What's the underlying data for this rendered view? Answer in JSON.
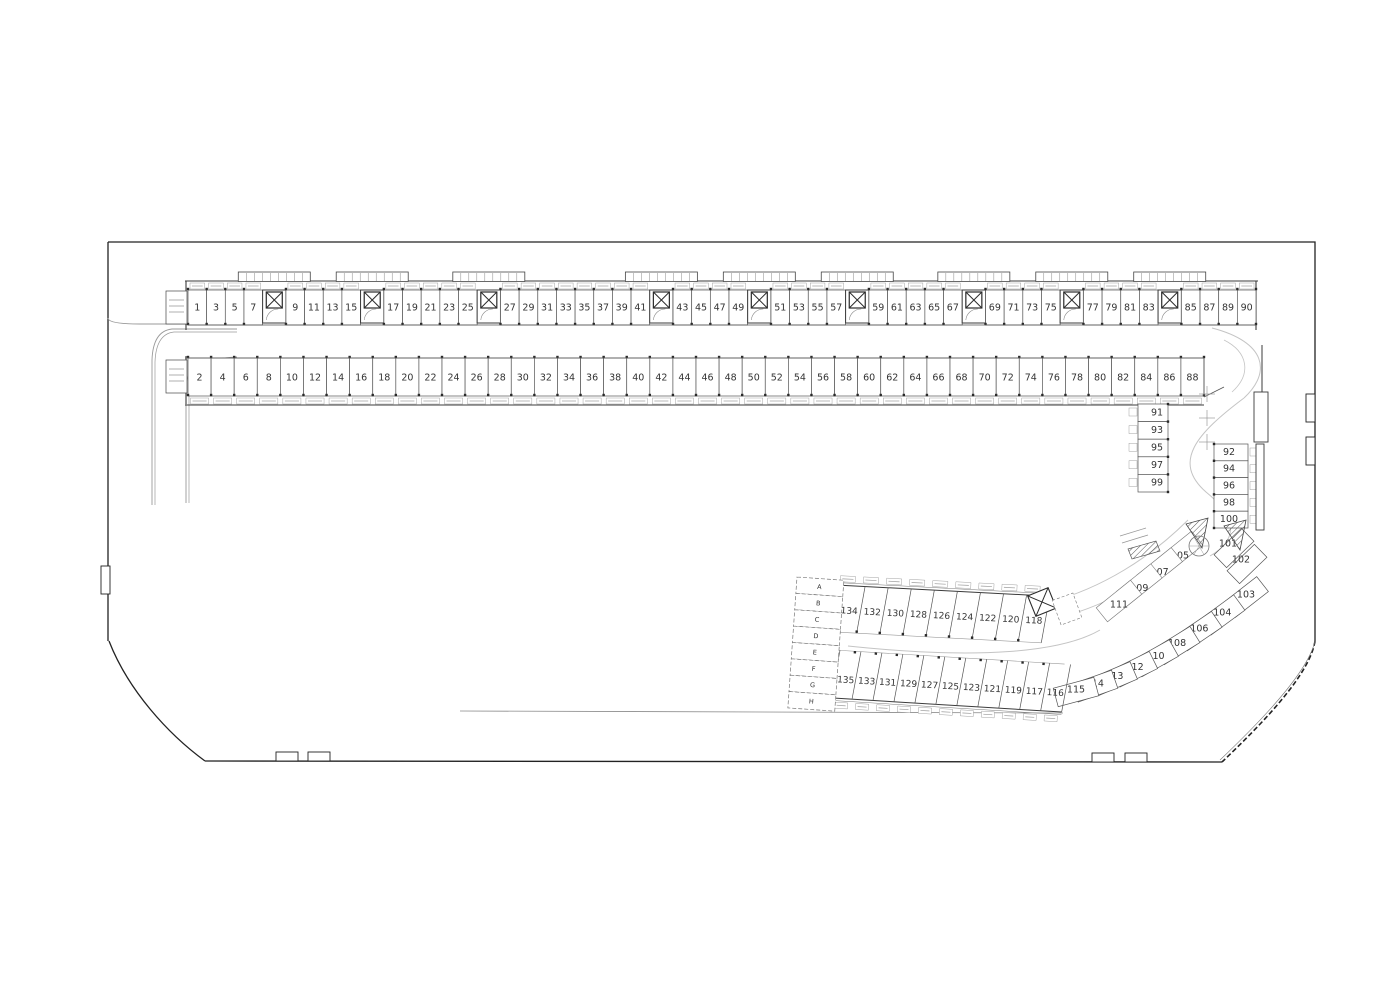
{
  "drawing": {
    "type": "parking-garage-floor-plan",
    "title": "",
    "stall_groups": {
      "top_row": {
        "sequence": [
          "1",
          "3",
          "5",
          "7",
          "CORE",
          "9",
          "11",
          "13",
          "15",
          "CORE",
          "17",
          "19",
          "21",
          "23",
          "25",
          "CORE",
          "27",
          "29",
          "31",
          "33",
          "35",
          "37",
          "39",
          "41",
          "CORE",
          "43",
          "45",
          "47",
          "49",
          "CORE",
          "51",
          "53",
          "55",
          "57",
          "CORE",
          "59",
          "61",
          "63",
          "65",
          "67",
          "CORE",
          "69",
          "71",
          "73",
          "75",
          "CORE",
          "77",
          "79",
          "81",
          "83",
          "CORE",
          "85",
          "87",
          "89",
          "90"
        ]
      },
      "bottom_row": {
        "sequence": [
          "2",
          "4",
          "6",
          "8",
          "10",
          "12",
          "14",
          "16",
          "18",
          "20",
          "22",
          "24",
          "26",
          "28",
          "30",
          "32",
          "34",
          "36",
          "38",
          "40",
          "42",
          "44",
          "46",
          "48",
          "50",
          "52",
          "54",
          "56",
          "58",
          "60",
          "62",
          "64",
          "66",
          "68",
          "70",
          "72",
          "74",
          "76",
          "78",
          "80",
          "82",
          "84",
          "86",
          "88"
        ]
      },
      "right_column_left": {
        "sequence": [
          "91",
          "93",
          "95",
          "97",
          "99"
        ]
      },
      "right_column_right": {
        "sequence": [
          "92",
          "94",
          "96",
          "98",
          "100"
        ]
      },
      "corner_pair": {
        "sequence": [
          "101",
          "102"
        ]
      },
      "curved_chain": {
        "sequence": [
          "103",
          "104",
          "106",
          "108",
          "110",
          "112",
          "113",
          "114",
          "115"
        ]
      },
      "ramp_row": {
        "sequence": [
          "105",
          "107",
          "109",
          "111"
        ]
      },
      "lower_upper_diag_row": {
        "sequence": [
          "134",
          "132",
          "130",
          "128",
          "126",
          "124",
          "122",
          "120",
          "118"
        ]
      },
      "lower_lower_diag_row": {
        "sequence": [
          "135",
          "133",
          "131",
          "129",
          "127",
          "125",
          "123",
          "121",
          "119",
          "117",
          "116"
        ]
      },
      "letter_cells": {
        "sequence": [
          "A",
          "B",
          "C",
          "D",
          "E",
          "F",
          "G",
          "H"
        ]
      }
    },
    "symbols": {
      "core_symbol": "elevator-x-box",
      "ramp_symbol": "spiral-ramp-circle",
      "stairs_symbol": "hatched-triangle"
    },
    "colors": {
      "boundary": "#222222",
      "wall": "#3b3b3b",
      "separator": "#555555",
      "light": "#c4c4c4",
      "road": "#9a9a9a",
      "tick": "#9d9d9d",
      "text": "#333333",
      "background": "#ffffff"
    }
  }
}
